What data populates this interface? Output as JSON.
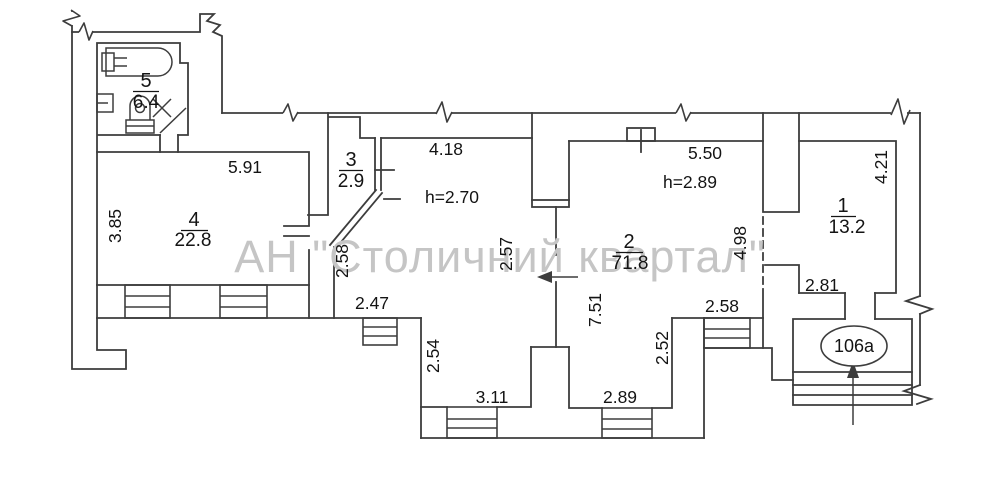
{
  "watermark": "АН \"Столичний квартал\"",
  "rooms": [
    {
      "id": "room-1",
      "number": "1",
      "area": "13.2"
    },
    {
      "id": "room-2",
      "number": "2",
      "area": "71.8"
    },
    {
      "id": "room-3",
      "number": "3",
      "area": "2.9"
    },
    {
      "id": "room-4",
      "number": "4",
      "area": "22.8"
    },
    {
      "id": "room-5",
      "number": "5",
      "area": "6.4"
    }
  ],
  "heights": {
    "hall": "h=2.70",
    "room2": "h=2.89"
  },
  "dims": {
    "room4_top": "5.91",
    "room4_left": "3.85",
    "hall_top": "4.18",
    "hall_left": "2.58",
    "hall_right": "2.57",
    "room2_top": "5.50",
    "room2_left": "7.51",
    "room2_right": "4.98",
    "room1_right": "4.21",
    "room1_bottom": "2.81",
    "bay_left_top": "2.47",
    "bay_left_side": "2.54",
    "bay_bottom_left": "3.11",
    "bay_bottom_right": "2.89",
    "bay_right_side": "2.52",
    "room2_window": "2.58"
  },
  "entrance": {
    "label": "106a"
  },
  "colors": {
    "wall": "#3d3d3d",
    "text": "#141414",
    "watermark": "#c5c5c5"
  }
}
